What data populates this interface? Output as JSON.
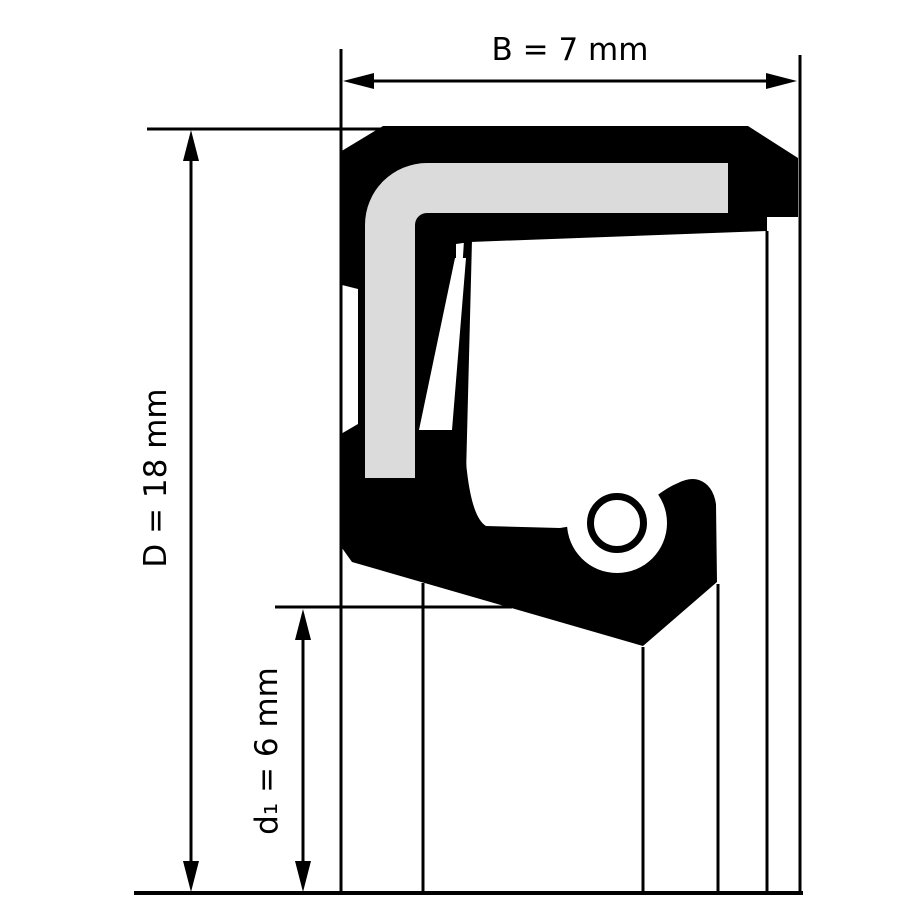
{
  "drawing": {
    "kind": "shaft-seal-cross-section",
    "labels": {
      "width_label": "B = 7 mm",
      "outer_diameter_label": "D = 18 mm",
      "inner_diameter_label": "d₁ = 6 mm"
    },
    "dimensions": {
      "width": {
        "symbol": "B",
        "value": 7,
        "unit": "mm"
      },
      "outer_diameter": {
        "symbol": "D",
        "value": 18,
        "unit": "mm"
      },
      "inner_diameter": {
        "symbol": "d1",
        "value": 6,
        "unit": "mm"
      }
    },
    "colors": {
      "line_black": "#000000",
      "rubber_black": "#000000",
      "metal_gray": "#dbdbdb",
      "background_white": "#ffffff"
    }
  }
}
